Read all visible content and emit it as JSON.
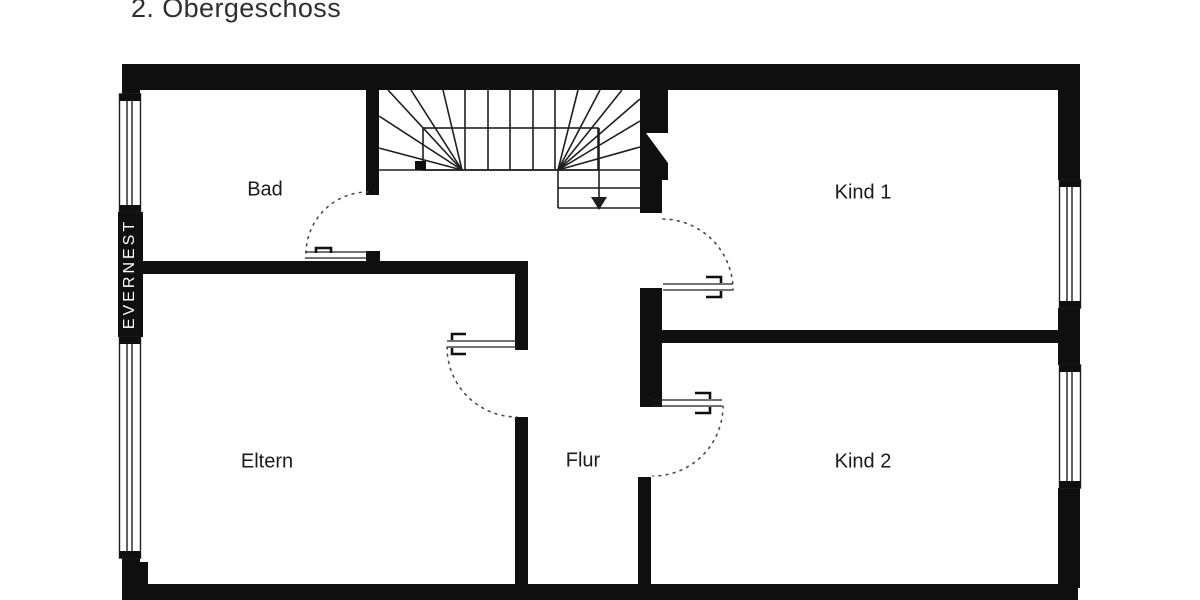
{
  "title": "2. Obergeschoss",
  "brand_watermark": "EVERNEST",
  "rooms": {
    "bad": "Bad",
    "kind1": "Kind 1",
    "eltern": "Eltern",
    "flur": "Flur",
    "kind2": "Kind 2"
  },
  "stairs": {
    "direction": "down"
  },
  "colors": {
    "wall": "#0f0f0f",
    "line": "#1f1f1f",
    "label": "#1a1a1a",
    "title": "#2f2f2f",
    "background": "#ffffff",
    "watermark": "#ffffff"
  }
}
